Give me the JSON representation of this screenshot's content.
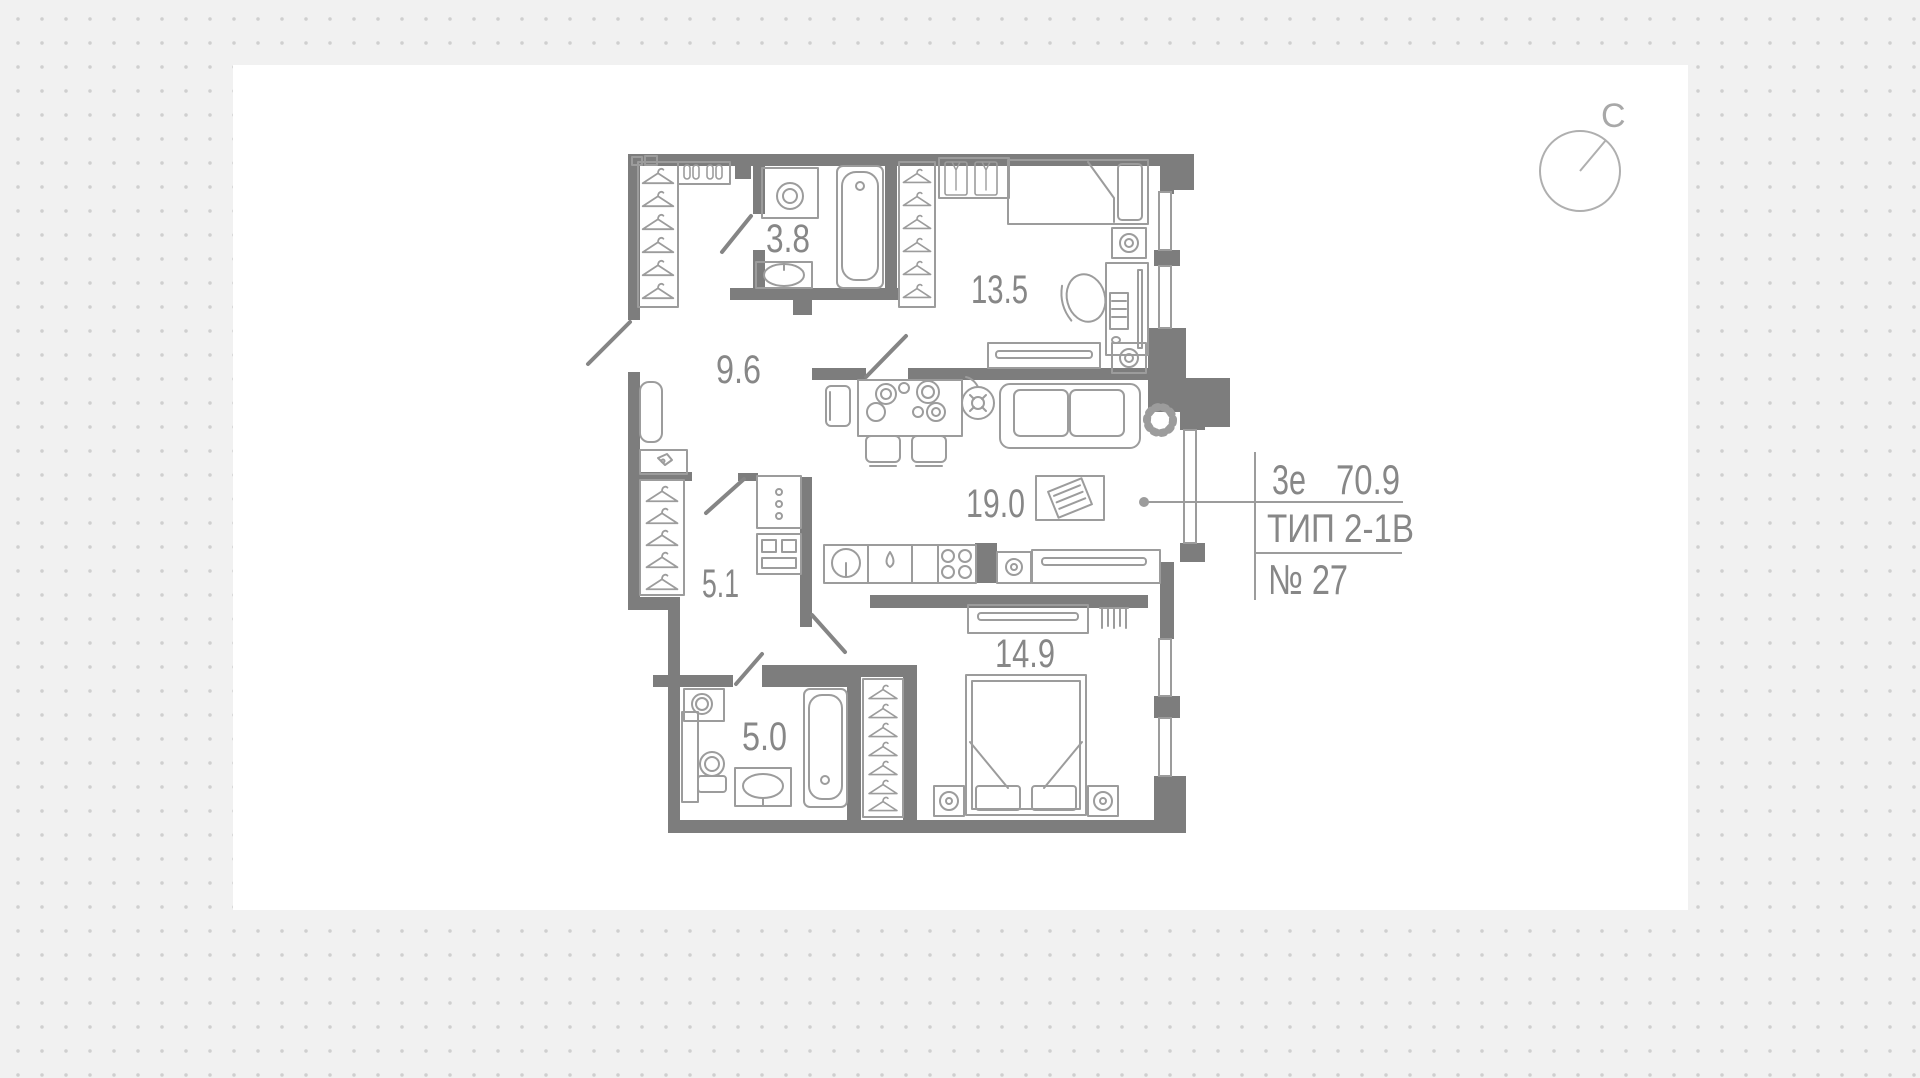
{
  "canvas": {
    "background_color": "#f1f1f1",
    "dot_color": "#cfcfcf",
    "card_color": "#ffffff",
    "wall_color": "#7d7d7d",
    "furniture_line_color": "#9c9c9c",
    "label_color": "#878787"
  },
  "plan": {
    "rooms": [
      {
        "area": "3.8"
      },
      {
        "area": "9.6"
      },
      {
        "area": "13.5"
      },
      {
        "area": "19.0"
      },
      {
        "area": "5.1"
      },
      {
        "area": "5.0"
      },
      {
        "area": "14.9"
      }
    ]
  },
  "annotation": {
    "plan_type": "3е",
    "total_area": "70.9",
    "layout_type": "ТИП 2-1В",
    "unit_number": "№ 27"
  },
  "compass": {
    "north_label": "С"
  }
}
